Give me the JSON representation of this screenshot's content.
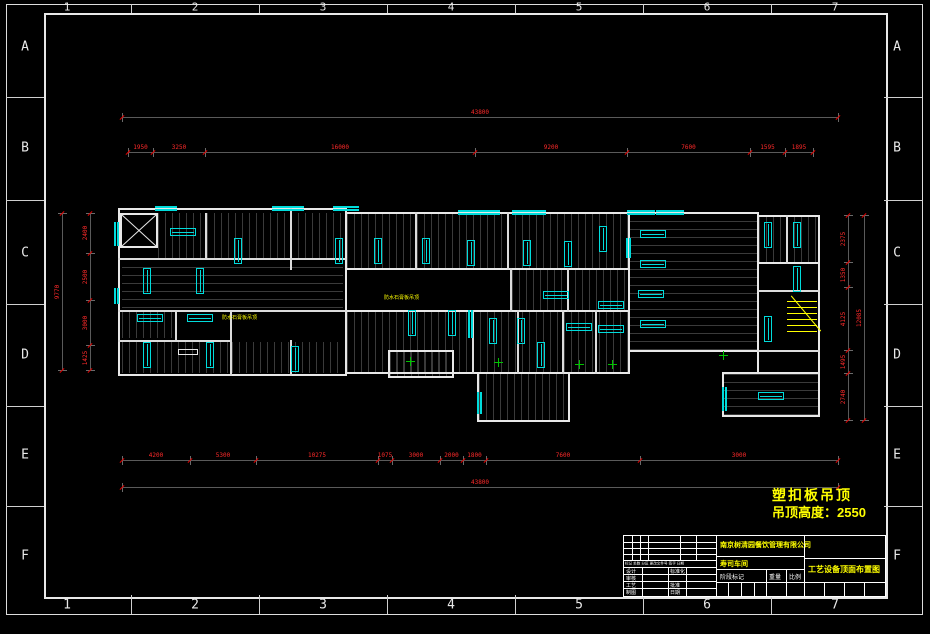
{
  "sheet": {
    "grid_cols": [
      "1",
      "2",
      "3",
      "4",
      "5",
      "6",
      "7"
    ],
    "grid_rows": [
      "A",
      "B",
      "C",
      "D",
      "E",
      "F"
    ]
  },
  "note": {
    "line1": "塑扣板吊顶",
    "line2": "吊顶高度：2550",
    "color": "#ffff00"
  },
  "title_block": {
    "company": "南京树清园餐饮管理有限公司",
    "project": "寿司车间",
    "drawing_title": "工艺设备顶面布置图",
    "stage_label": "阶段标记",
    "weight_label": "重量",
    "scale_label": "比例",
    "rev_header": "标记 处数 分区 更改文件号 签字 日期",
    "left_col1": [
      "设计",
      "审核",
      "工艺",
      "制图"
    ],
    "left_col2": [
      "标准化",
      "",
      "批准",
      "日期"
    ]
  },
  "dimensions": {
    "color": "#ff2a2a",
    "top_total": {
      "y": 117,
      "bounds": [
        122,
        838
      ],
      "labels": [
        "43800"
      ]
    },
    "top_chain": {
      "y": 152,
      "bounds": [
        128,
        153,
        205,
        475,
        627,
        750,
        785,
        813
      ],
      "labels": [
        "1950",
        "3250",
        "16000",
        "9200",
        "7600",
        "1595",
        "1895"
      ]
    },
    "bottom_chain": {
      "y": 460,
      "bounds": [
        122,
        190,
        256,
        378,
        392,
        440,
        463,
        486,
        640,
        838
      ],
      "labels": [
        "4200",
        "5300",
        "10275",
        "1075",
        "3000",
        "2000",
        "1800",
        "7600",
        "3000"
      ]
    },
    "bottom_total": {
      "y": 487,
      "bounds": [
        122,
        838
      ],
      "labels": [
        "43800"
      ]
    },
    "left_total": {
      "x": 62,
      "bounds": [
        213,
        370
      ],
      "labels": [
        "9770"
      ]
    },
    "left_chain": {
      "x": 90,
      "bounds": [
        213,
        253,
        300,
        345,
        370
      ],
      "labels": [
        "2400",
        "2500",
        "3000",
        "1425"
      ]
    },
    "right_chain": {
      "x": 848,
      "bounds": [
        215,
        262,
        287,
        350,
        373,
        420
      ],
      "labels": [
        "2375",
        "1350",
        "4125",
        "1495",
        "2740"
      ]
    },
    "right_total": {
      "x": 864,
      "bounds": [
        215,
        420
      ],
      "labels": [
        "12085"
      ]
    }
  },
  "plan": {
    "room_labels": [
      {
        "text": "防水石膏板吊顶",
        "x": 222,
        "y": 315
      },
      {
        "text": "防水石膏板吊顶",
        "x": 384,
        "y": 295
      }
    ],
    "walls": [
      [
        118,
        208,
        229,
        168
      ],
      [
        345,
        212,
        285,
        58
      ],
      [
        628,
        212,
        131,
        140
      ],
      [
        757,
        215,
        63,
        49
      ],
      [
        757,
        262,
        63,
        112
      ],
      [
        722,
        372,
        98,
        45
      ],
      [
        345,
        268,
        285,
        44
      ],
      [
        345,
        310,
        285,
        64
      ],
      [
        477,
        372,
        93,
        50
      ],
      [
        388,
        350,
        66,
        28
      ]
    ],
    "wall_lines": [
      [
        205,
        213,
        0,
        45
      ],
      [
        290,
        208,
        0,
        62
      ],
      [
        118,
        258,
        229,
        0
      ],
      [
        118,
        310,
        229,
        0
      ],
      [
        230,
        310,
        0,
        66
      ],
      [
        175,
        310,
        0,
        30
      ],
      [
        118,
        340,
        114,
        0
      ],
      [
        290,
        340,
        0,
        36
      ],
      [
        415,
        212,
        0,
        58
      ],
      [
        507,
        212,
        0,
        58
      ],
      [
        510,
        268,
        0,
        44
      ],
      [
        567,
        268,
        0,
        44
      ],
      [
        472,
        310,
        0,
        64
      ],
      [
        517,
        310,
        0,
        64
      ],
      [
        562,
        310,
        0,
        64
      ],
      [
        595,
        310,
        0,
        64
      ],
      [
        786,
        215,
        0,
        49
      ],
      [
        757,
        290,
        63,
        0
      ],
      [
        757,
        350,
        63,
        0
      ]
    ],
    "rooms": [
      [
        158,
        213,
        187,
        45,
        "v"
      ],
      [
        122,
        260,
        221,
        48,
        "h"
      ],
      [
        347,
        214,
        281,
        54,
        "v"
      ],
      [
        630,
        214,
        127,
        136,
        "h"
      ],
      [
        759,
        217,
        59,
        45,
        "v"
      ],
      [
        512,
        270,
        116,
        40,
        "v"
      ],
      [
        347,
        312,
        281,
        60,
        "v"
      ],
      [
        724,
        374,
        94,
        41,
        "h"
      ],
      [
        479,
        374,
        89,
        46,
        "v"
      ],
      [
        122,
        342,
        106,
        31,
        "v"
      ],
      [
        232,
        342,
        111,
        31,
        "v"
      ],
      [
        122,
        312,
        51,
        26,
        "v"
      ],
      [
        390,
        352,
        62,
        24,
        "v"
      ]
    ],
    "fixtures_v": [
      [
        234,
        238
      ],
      [
        335,
        238
      ],
      [
        374,
        238
      ],
      [
        422,
        238
      ],
      [
        467,
        240
      ],
      [
        523,
        240
      ],
      [
        564,
        241
      ],
      [
        599,
        226
      ],
      [
        764,
        222
      ],
      [
        793,
        222
      ],
      [
        793,
        266
      ],
      [
        764,
        316
      ],
      [
        143,
        268
      ],
      [
        196,
        268
      ],
      [
        408,
        310
      ],
      [
        448,
        310
      ],
      [
        489,
        318
      ],
      [
        517,
        318
      ],
      [
        537,
        342
      ],
      [
        143,
        342
      ],
      [
        206,
        342
      ],
      [
        291,
        346
      ]
    ],
    "fixtures_h": [
      [
        170,
        228
      ],
      [
        137,
        314
      ],
      [
        187,
        314
      ],
      [
        640,
        230
      ],
      [
        640,
        260
      ],
      [
        638,
        290
      ],
      [
        640,
        320
      ],
      [
        543,
        291
      ],
      [
        598,
        301
      ],
      [
        566,
        323
      ],
      [
        598,
        325
      ],
      [
        758,
        392
      ]
    ],
    "windows": [
      [
        155,
        206,
        22,
        5
      ],
      [
        272,
        206,
        32,
        5
      ],
      [
        333,
        206,
        26,
        5
      ],
      [
        458,
        210,
        42,
        5
      ],
      [
        512,
        210,
        34,
        5
      ],
      [
        627,
        210,
        28,
        5
      ],
      [
        656,
        210,
        28,
        5
      ],
      [
        114,
        222,
        5,
        24
      ],
      [
        114,
        288,
        5,
        16
      ],
      [
        468,
        310,
        5,
        28
      ],
      [
        626,
        238,
        5,
        20
      ],
      [
        722,
        387,
        5,
        24
      ],
      [
        477,
        392,
        5,
        22
      ]
    ],
    "crosses": [
      [
        406,
        357
      ],
      [
        494,
        358
      ],
      [
        575,
        360
      ],
      [
        608,
        360
      ],
      [
        719,
        351
      ]
    ],
    "boxes": [
      [
        178,
        349,
        20,
        6
      ]
    ]
  }
}
